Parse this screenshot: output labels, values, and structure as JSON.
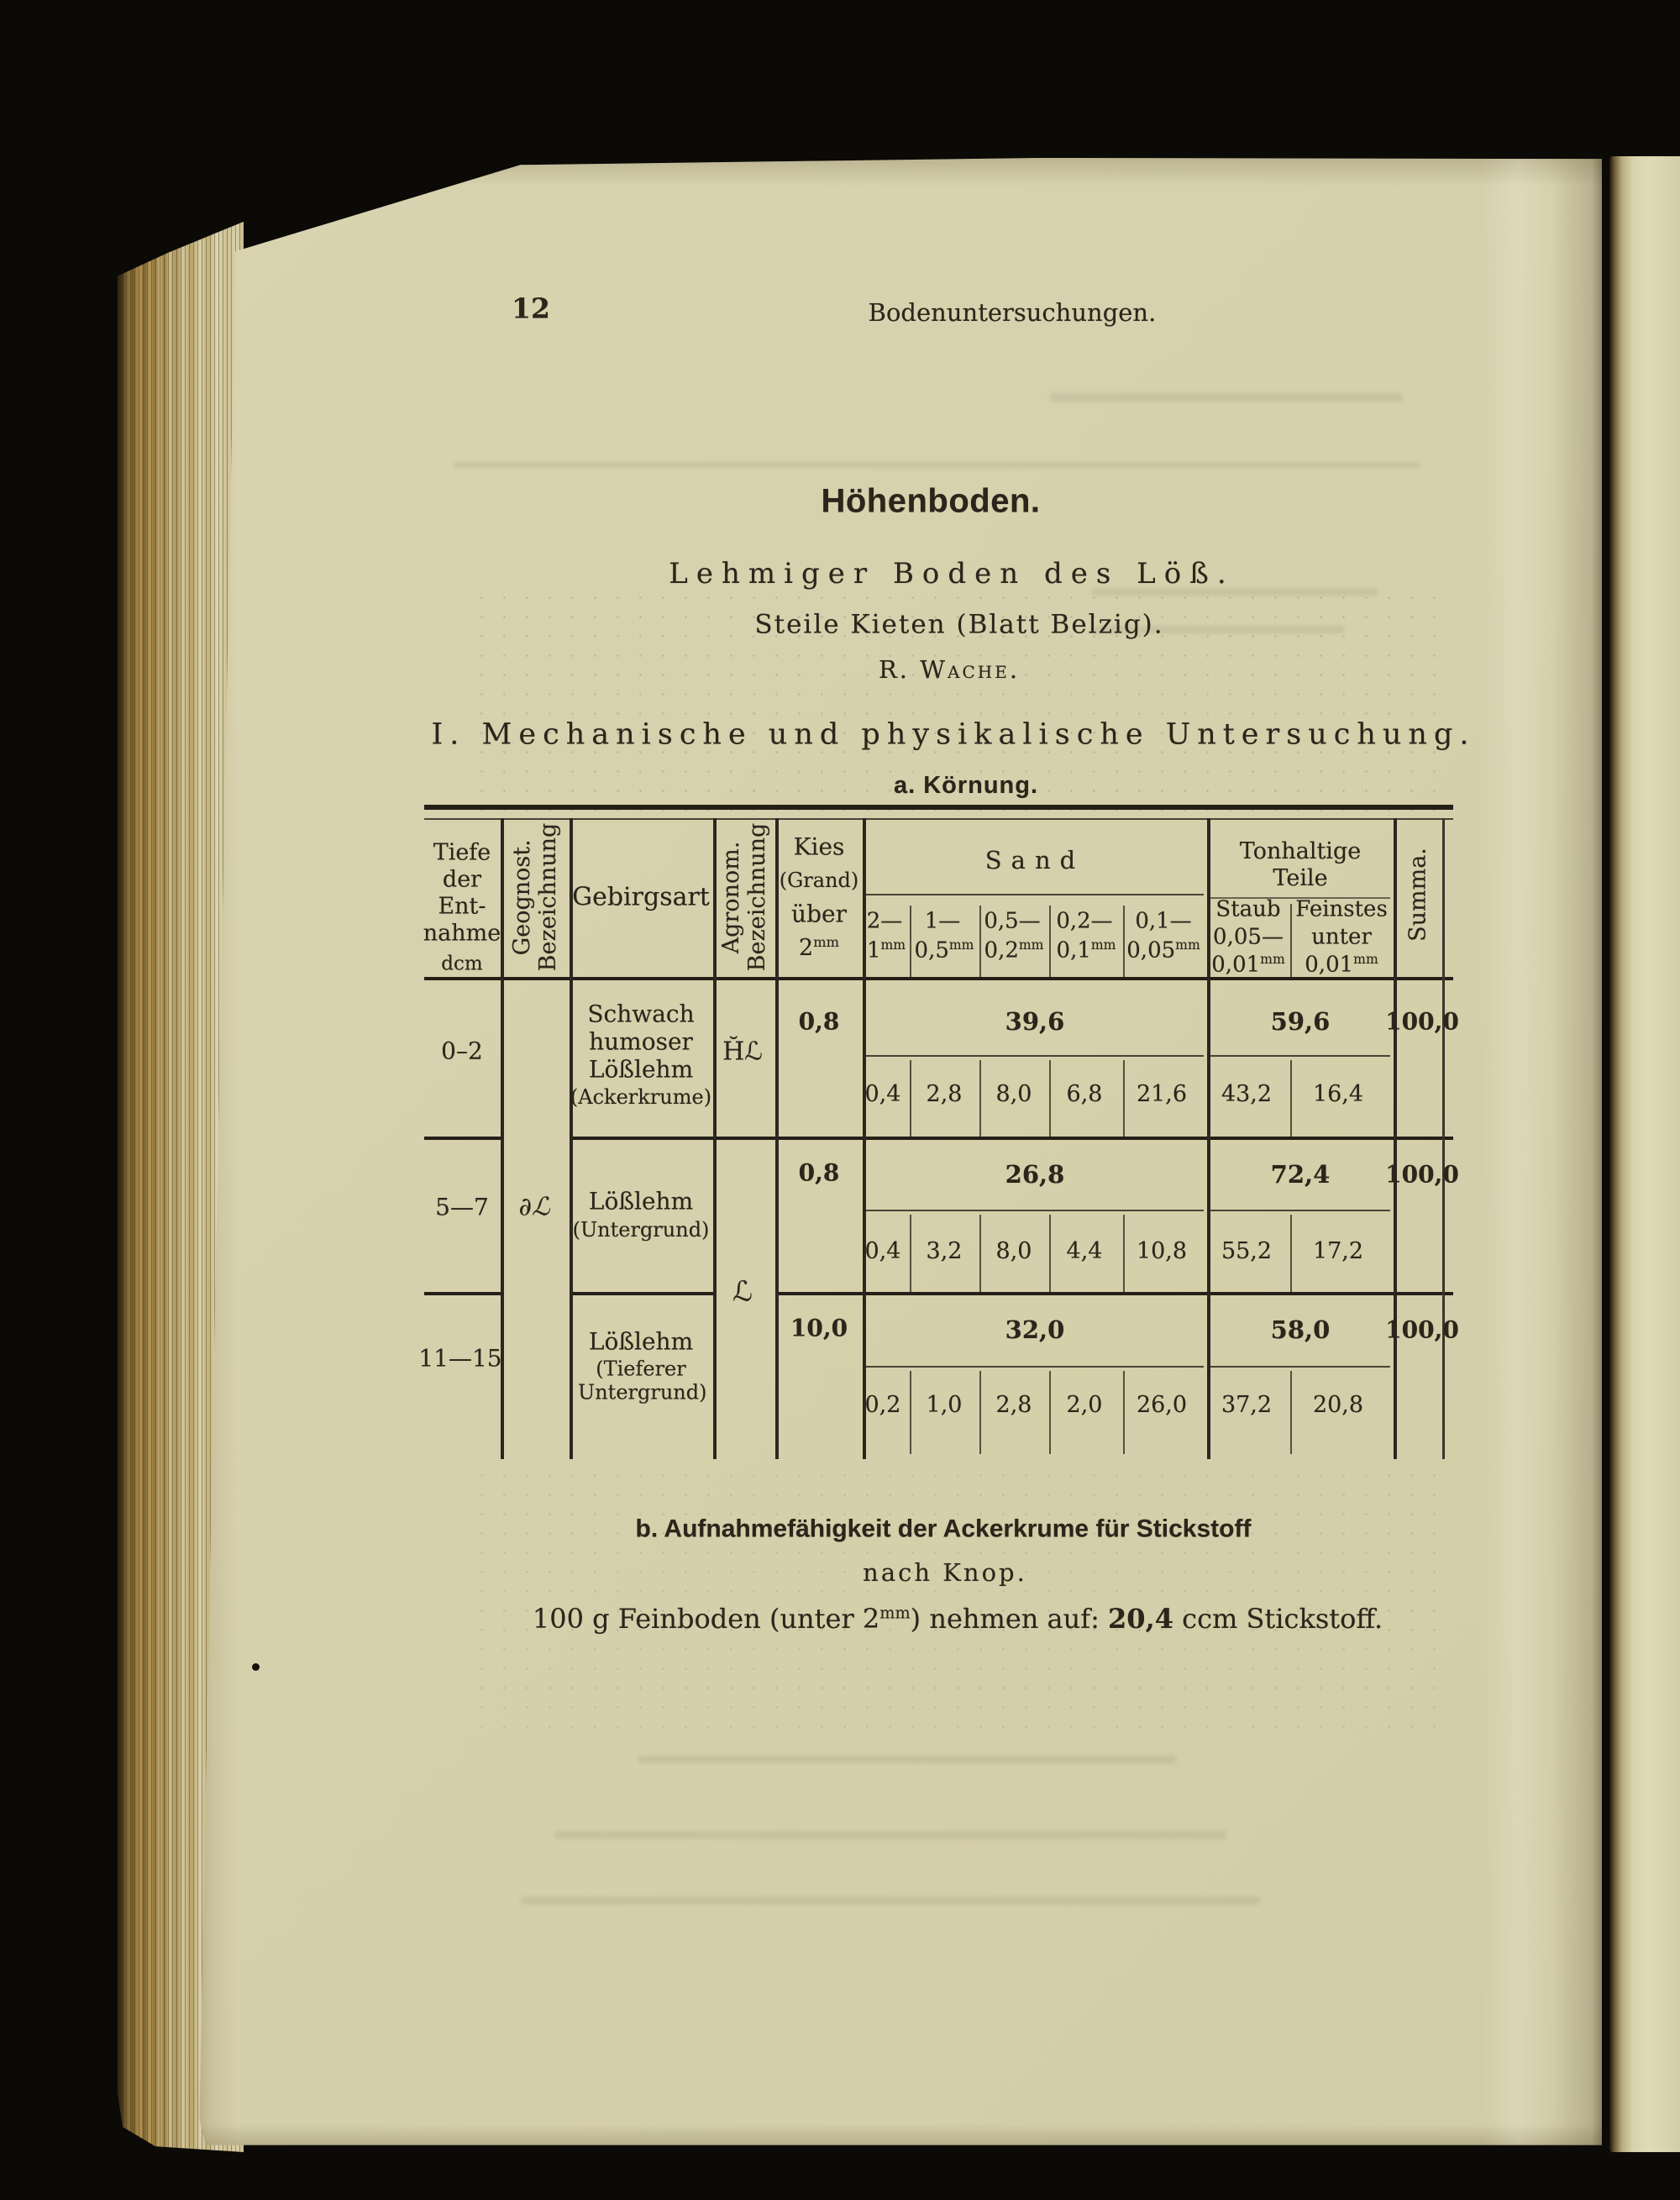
{
  "page_header": {
    "page_number": "12",
    "running_title": "Bodenuntersuchungen."
  },
  "titles": {
    "main": "Höhenboden.",
    "subtitle": "Lehmiger Boden des Löß.",
    "location": "Steile Kieten (Blatt Belzig).",
    "author": "R. Wache.",
    "section": "I. Mechanische und physikalische Untersuchung.",
    "subsection": "a. Körnung."
  },
  "table": {
    "col_depth": {
      "label": "Tiefe\nder\nEnt-\nnahme",
      "unit": "dcm"
    },
    "col_geognost": "Geognost.\nBezeichnung",
    "col_gebirgsart": "Gebirgsart",
    "col_agronom": "Agronom.\nBezeichnung",
    "col_kies": {
      "l1": "Kies",
      "l2": "(Grand)",
      "l3": "über",
      "value": "2",
      "sup": "mm"
    },
    "group_sand": "Sand",
    "sand_cols": [
      {
        "top": "2—",
        "bottom": "1",
        "sup": "mm"
      },
      {
        "top": "1—",
        "bottom": "0,5",
        "sup": "mm"
      },
      {
        "top": "0,5—",
        "bottom": "0,2",
        "sup": "mm"
      },
      {
        "top": "0,2—",
        "bottom": "0,1",
        "sup": "mm"
      },
      {
        "top": "0,1—",
        "bottom": "0,05",
        "sup": "mm"
      }
    ],
    "group_ton": "Tonhaltige\nTeile",
    "col_staub": {
      "l1": "Staub",
      "l2": "0,05—",
      "l3": "0,01",
      "sup": "mm"
    },
    "col_feinstes": {
      "l1": "Feinstes",
      "l2": "unter",
      "l3": "0,01",
      "sup": "mm"
    },
    "col_summa": "Summa.",
    "rows": [
      {
        "depth": "0–2",
        "geognost": "",
        "gebirgsart": "Schwach humoser Lößlehm",
        "note": "(Ackerkrume)",
        "agronom": "H̆ℒ",
        "kies": "0,8",
        "sand_total": "39,6",
        "sand": [
          "0,4",
          "2,8",
          "8,0",
          "6,8",
          "21,6"
        ],
        "ton_total": "59,6",
        "staub": "43,2",
        "feinstes": "16,4",
        "summa": "100,0"
      },
      {
        "depth": "5—7",
        "geognost": "∂ℒ",
        "gebirgsart": "Lößlehm",
        "note": "(Untergrund)",
        "agronom": "ℒ",
        "kies": "0,8",
        "sand_total": "26,8",
        "sand": [
          "0,4",
          "3,2",
          "8,0",
          "4,4",
          "10,8"
        ],
        "ton_total": "72,4",
        "staub": "55,2",
        "feinstes": "17,2",
        "summa": "100,0"
      },
      {
        "depth": "11—15",
        "geognost": "",
        "gebirgsart": "Lößlehm",
        "note": "(Tieferer Untergrund)",
        "agronom": "",
        "kies": "10,0",
        "sand_total": "32,0",
        "sand": [
          "0,2",
          "1,0",
          "2,8",
          "2,0",
          "26,0"
        ],
        "ton_total": "58,0",
        "staub": "37,2",
        "feinstes": "20,8",
        "summa": "100,0"
      }
    ]
  },
  "section_b": {
    "heading": "b. Aufnahmefähigkeit der Ackerkrume für Stickstoff",
    "subheading": "nach Knop.",
    "line": {
      "pre": "100 g Feinboden (unter 2",
      "sup": "mm",
      "mid": ") nehmen auf: ",
      "value": "20,4",
      "post": " ccm Stickstoff."
    }
  }
}
